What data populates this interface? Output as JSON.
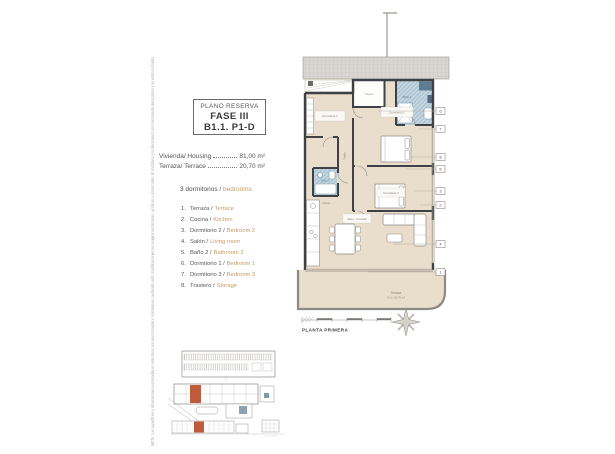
{
  "titleblock": {
    "heading": "PLANO RESERVA",
    "phase": "FASE III",
    "unit": "B1.1. P1-D"
  },
  "areas": [
    {
      "label": "Vivienda/ Housing",
      "value": "81,00 m²"
    },
    {
      "label": "Terraza/ Terrace",
      "value": "20,70 m²"
    }
  ],
  "bedrooms": {
    "es": "3 dormitorios /",
    "en": "bedrooms"
  },
  "room_list": [
    {
      "num": "1.",
      "es": "Terraza /",
      "en": "Terrace"
    },
    {
      "num": "2.",
      "es": "Cocina /",
      "en": "Kitchen"
    },
    {
      "num": "3.",
      "es": "Dormitorio 2 /",
      "en": "Bedroom 2"
    },
    {
      "num": "4.",
      "es": "Salón /",
      "en": "Living room"
    },
    {
      "num": "5.",
      "es": "Baño 2 /",
      "en": "Bathroom 2"
    },
    {
      "num": "6.",
      "es": "Dormitorio 1 /",
      "en": "Bedroom 1"
    },
    {
      "num": "7.",
      "es": "Dormitorio 3 /",
      "en": "Bedroom 3"
    },
    {
      "num": "8.",
      "es": "Trastero /",
      "en": "Storage"
    }
  ],
  "plan": {
    "floor_label": "PLANTA PRIMERA",
    "markers": [
      "6",
      "7",
      "8",
      "5",
      "3",
      "2",
      "4",
      "1"
    ],
    "room_labels": {
      "dorm1": "Dormitorio 1",
      "dorm2": "Dormitorio 2",
      "dorm3": "Dormitorio 3",
      "salon": "Salón - Comedor",
      "cocina": "Cocina",
      "bano1": "Baño 1",
      "bano2": "Baño 2",
      "pasillo": "Pasillo",
      "trastero": "Trastero",
      "terraza": "Terraza",
      "terraza_area": "S.U.: 20,70 m²"
    }
  },
  "disclaimer": "NOTA: Las superficies y dimensiones expresadas en este plano son aproximadas y orientativas, pudiendo sufrir modificaciones por exigencias técnicas, jurídicas o comerciales. El mobiliario y la decoración son meramente decorativos y no están incluidos.",
  "colors": {
    "accent_orange": "#c59b63",
    "floor_beige": "#e9ddcb",
    "bath_blue": "#afc7d5",
    "wall_dark": "#3e4246",
    "highlight_red": "#c05a3c"
  }
}
